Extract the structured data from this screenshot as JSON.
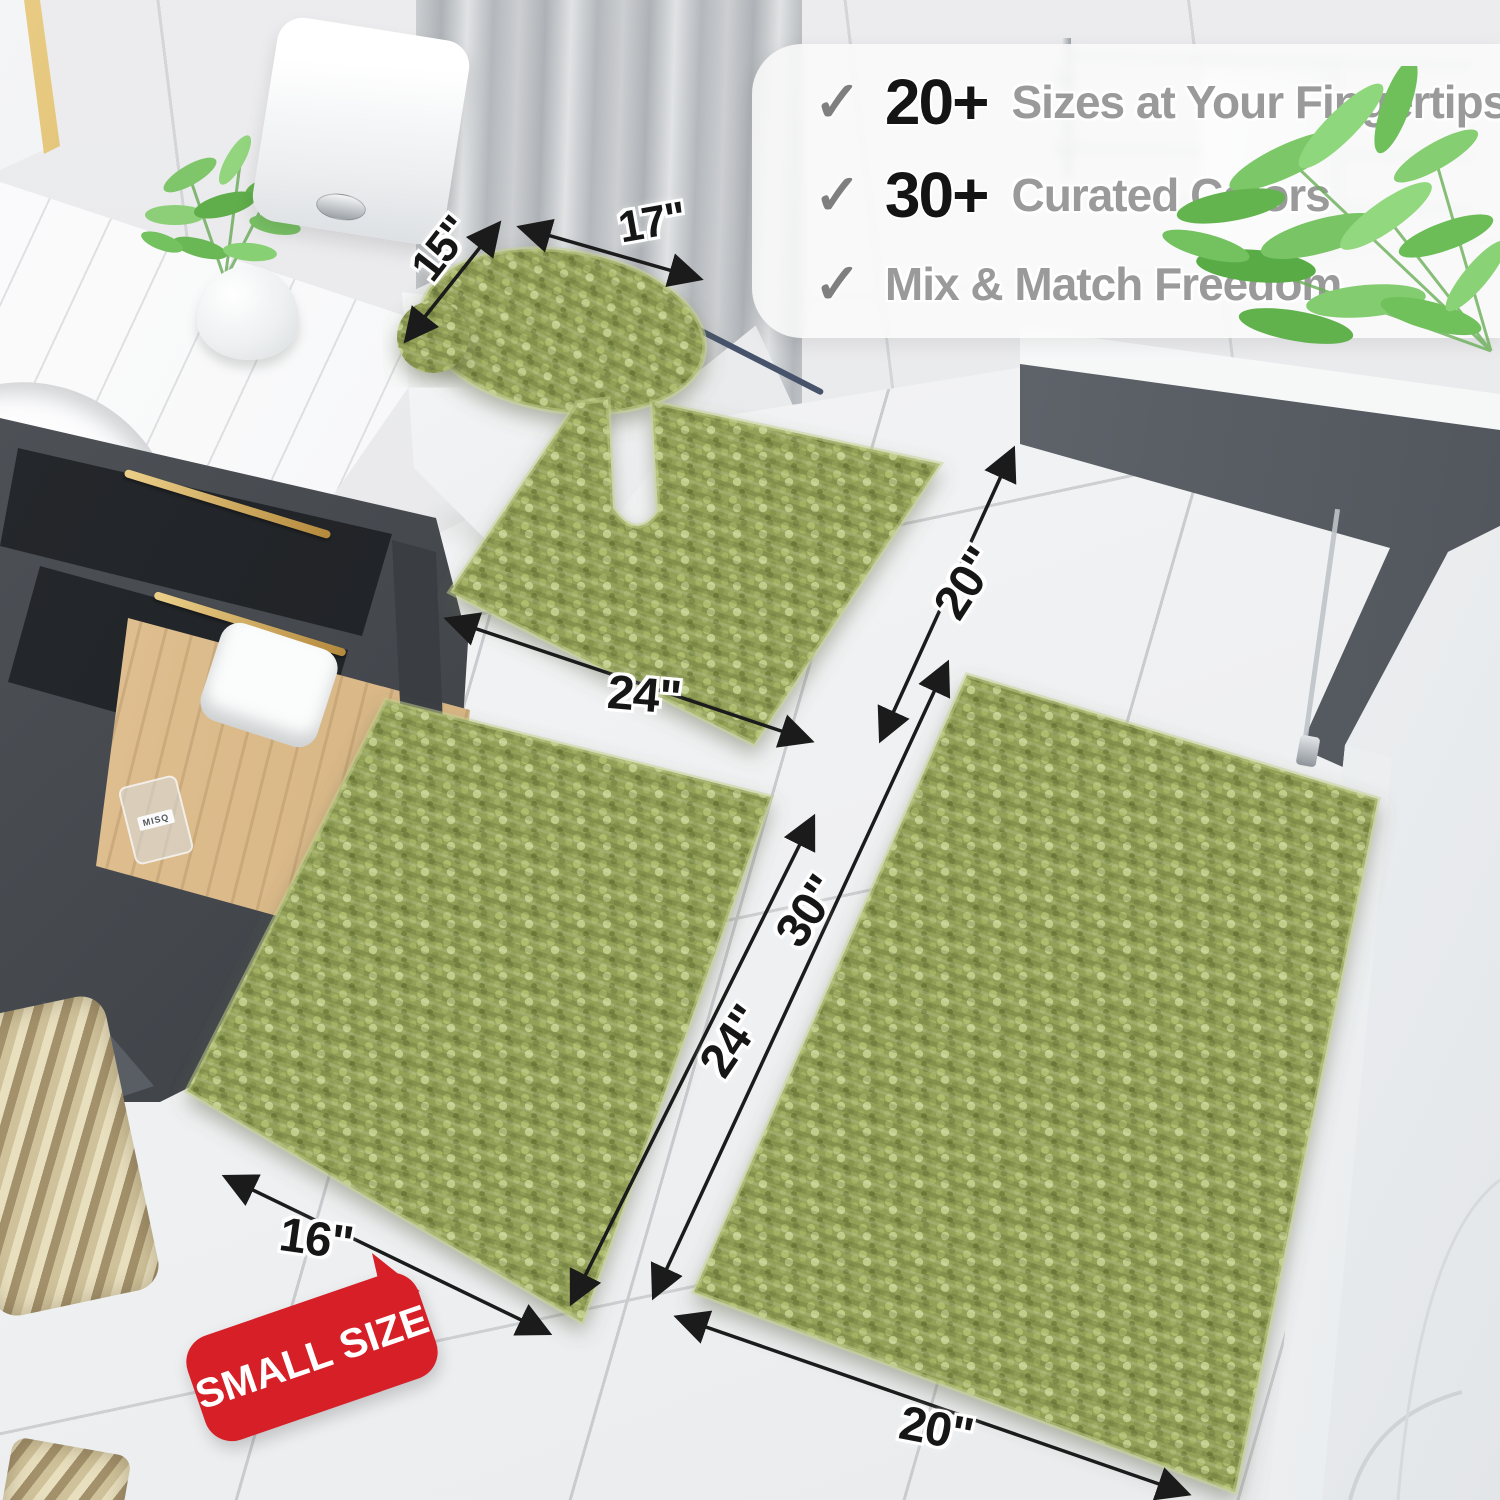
{
  "meta": {
    "description": "Product photo of a 4-piece olive green chenille bathroom rug set (toilet lid cover, contour rug, small rug, large rug) in a bathroom, annotated with size arrows, a feature list and a SMALL SIZE badge"
  },
  "features": {
    "check_icon": "✓",
    "items": [
      {
        "stat": "20+",
        "label": "Sizes at Your Fingertips"
      },
      {
        "stat": "30+",
        "label": "Curated Colors"
      },
      {
        "stat": "",
        "label": "Mix & Match Freedom"
      }
    ]
  },
  "dimension_labels": {
    "lid_depth": "15\"",
    "lid_width": "17\"",
    "contour_width": "24\"",
    "contour_depth": "20\"",
    "large_length": "30\"",
    "small_length": "24\"",
    "small_width": "16\"",
    "large_width": "20\""
  },
  "badge": {
    "label": "SMALL SIZE"
  },
  "bottle_label": "MISQ",
  "palette": {
    "rug_green": "#93a159",
    "rug_green_light": "#c0cd8a",
    "rug_green_dark": "#75833f",
    "badge_red": "#d61f27",
    "arrow_black": "#1b1b1b",
    "stat_black": "#141414",
    "feature_gray": "#9a9a9a",
    "gold_hardware": "#c79d4e"
  }
}
